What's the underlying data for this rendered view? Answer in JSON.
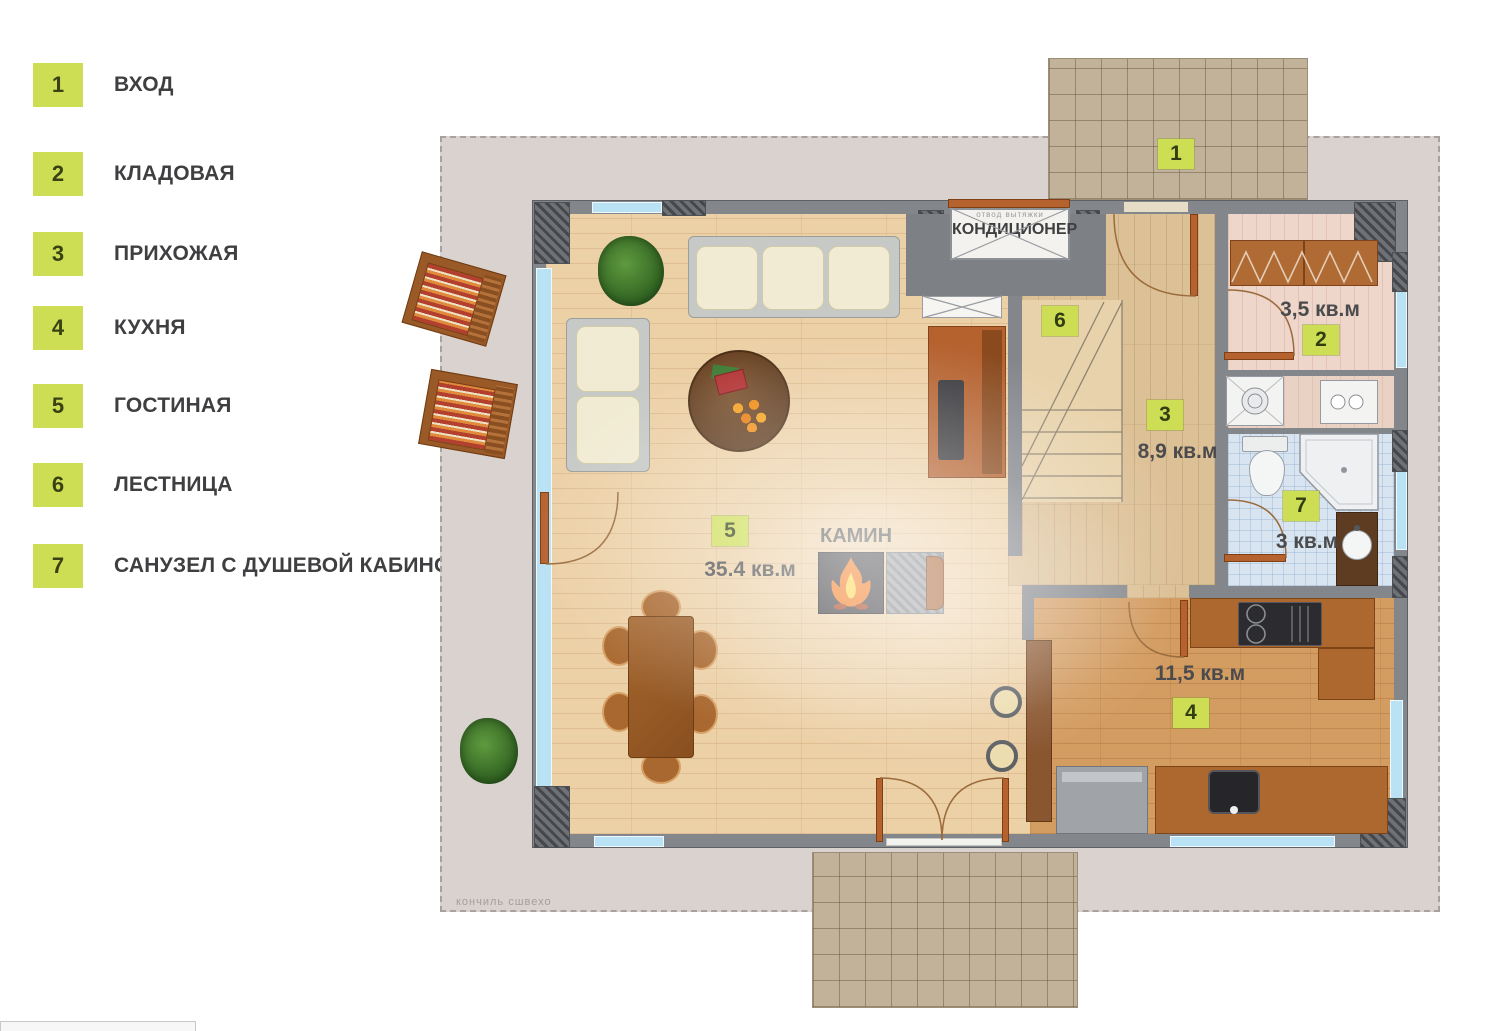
{
  "legend": {
    "items": [
      {
        "num": "1",
        "label": "ВХОД"
      },
      {
        "num": "2",
        "label": "КЛАДОВАЯ"
      },
      {
        "num": "3",
        "label": "ПРИХОЖАЯ"
      },
      {
        "num": "4",
        "label": "КУХНЯ"
      },
      {
        "num": "5",
        "label": "ГОСТИНАЯ"
      },
      {
        "num": "6",
        "label": "ЛЕСТНИЦА"
      },
      {
        "num": "7",
        "label": "САНУЗЕЛ С ДУШЕВОЙ КАБИНОЙ"
      }
    ]
  },
  "plan": {
    "ac_label": "КОНДИЦИОНЕР",
    "ac_note": "отвод вытяжки",
    "fireplace_label": "КАМИН",
    "caption": "кончиль сшвехо",
    "rooms": [
      {
        "num": "1",
        "area": ""
      },
      {
        "num": "2",
        "area": "3,5 кв.м"
      },
      {
        "num": "3",
        "area": "8,9 кв.м"
      },
      {
        "num": "4",
        "area": "11,5 кв.м"
      },
      {
        "num": "5",
        "area": "35.4 кв.м"
      },
      {
        "num": "6",
        "area": ""
      },
      {
        "num": "7",
        "area": "3 кв.м"
      }
    ]
  },
  "colors": {
    "accent_lime": "#cdde55",
    "wall_gray": "#83868b",
    "window_blue": "#b9e2f4",
    "door_orange": "#b5622f",
    "wood_light": "#ecd0a6",
    "wood_kitchen": "#d39c61",
    "bath_tile": "#d8e5f0",
    "patio_tile": "#c2b29a"
  }
}
